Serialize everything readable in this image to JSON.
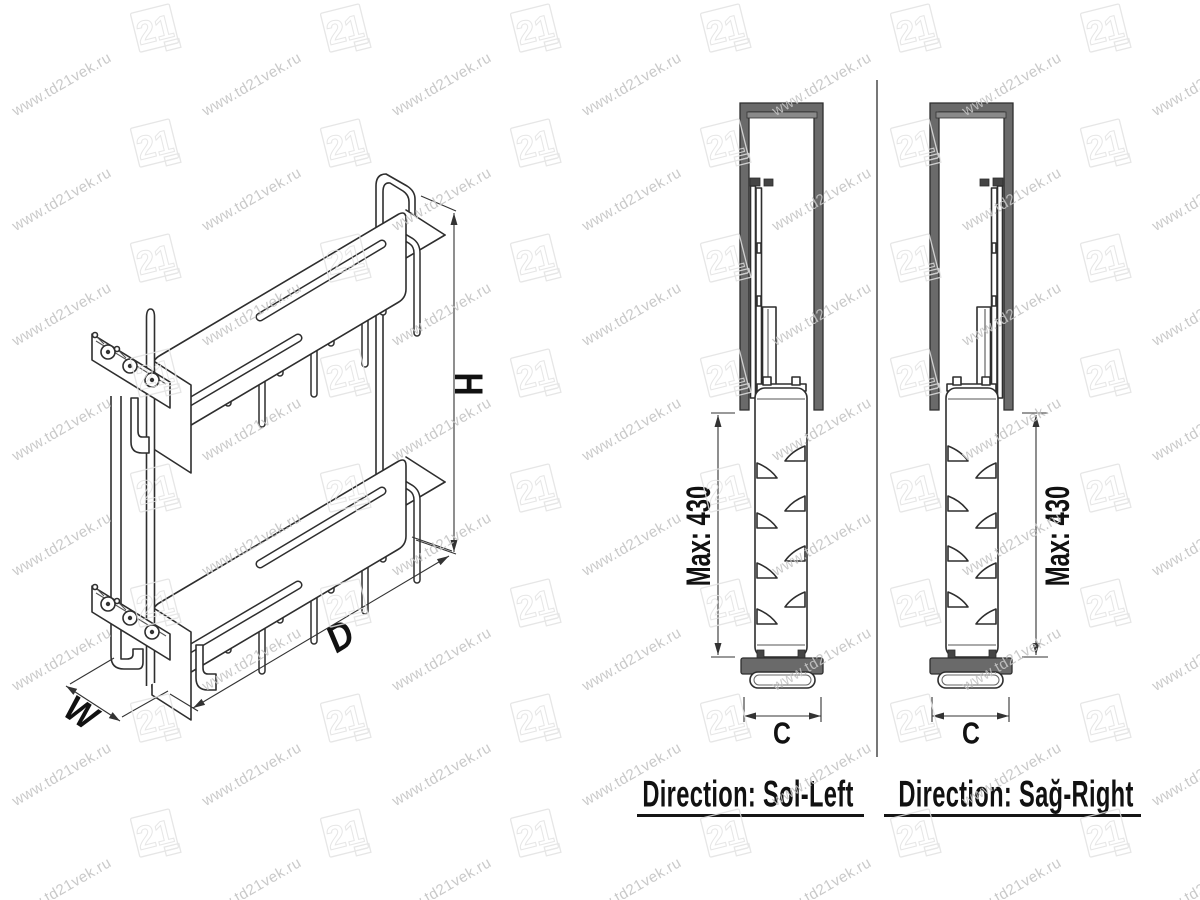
{
  "watermark": {
    "text": "www.td21vek.ru",
    "logo_text": "21",
    "text_color": "#c4c4c4",
    "logo_color": "#e2e2e2"
  },
  "isometric_view": {
    "width_label": "W",
    "depth_label": "D",
    "height_label": "H"
  },
  "side_views": {
    "left": {
      "max_label": "Max: 430",
      "width_label": "C",
      "direction_label": "Direction: Sol-Left"
    },
    "right": {
      "max_label": "Max: 430",
      "width_label": "C",
      "direction_label": "Direction: Sağ-Right"
    }
  },
  "colors": {
    "background": "#ffffff",
    "line": "#2e2e2e",
    "panel_gray": "#6a6a6a",
    "label_text": "#111111"
  }
}
